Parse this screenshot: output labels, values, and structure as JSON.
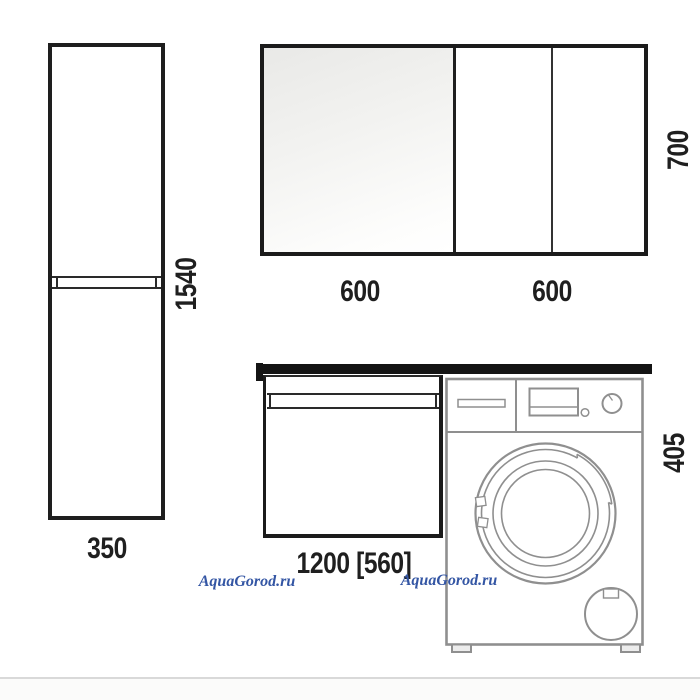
{
  "dimensions": {
    "tall_cabinet_height": "1540",
    "tall_cabinet_width": "350",
    "mirror_section_left_width": "600",
    "mirror_section_right_width": "600",
    "mirror_height": "700",
    "vanity_width": "1200 [560]",
    "washer_section_height": "405"
  },
  "watermark": {
    "text": "AquaGorod.ru",
    "color": "#3456a4"
  },
  "colors": {
    "drawing_line_dark": "#1e1e1e",
    "drawing_line_gray": "#8f8f8f",
    "mirror_glass_tint": "#e9e9e7",
    "watermark_blue": "#3456a4"
  }
}
